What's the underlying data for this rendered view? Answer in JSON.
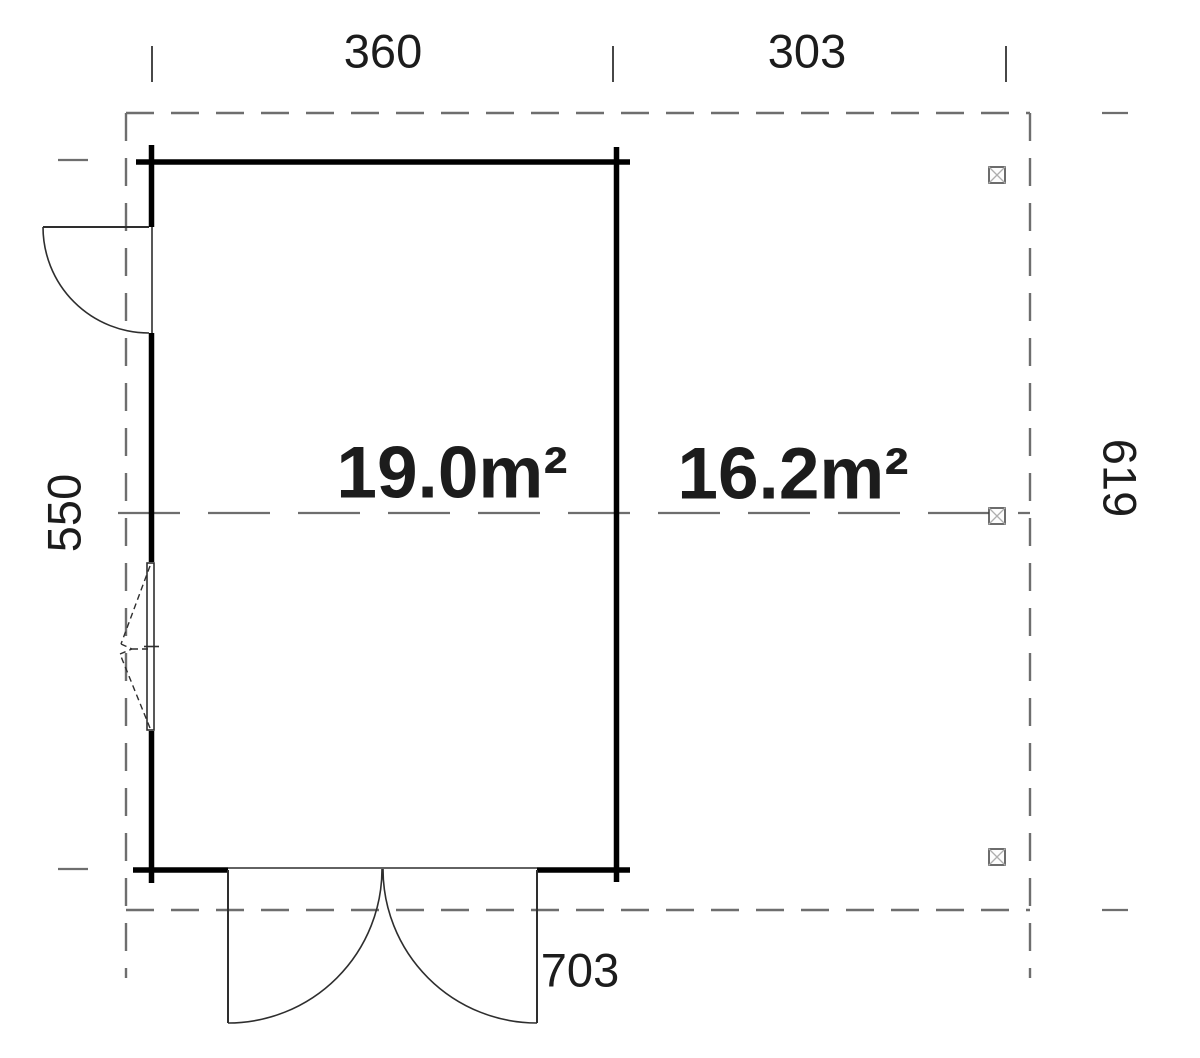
{
  "plan": {
    "dimension_labels": {
      "width_main": "360",
      "width_side": "303",
      "height_left": "550",
      "height_right": "619",
      "width_total": "703"
    },
    "area_labels": {
      "main_room": "19.0m²",
      "side_area": "16.2m²"
    },
    "colors": {
      "background": "#ffffff",
      "wall": "#000000",
      "dash_line": "#6e6e6e",
      "thin_line": "#2e2e2e",
      "tick": "#333333",
      "post_stroke": "#3c3c3c",
      "post_cross": "#aeaeae",
      "text": "#1c1c1c"
    }
  }
}
